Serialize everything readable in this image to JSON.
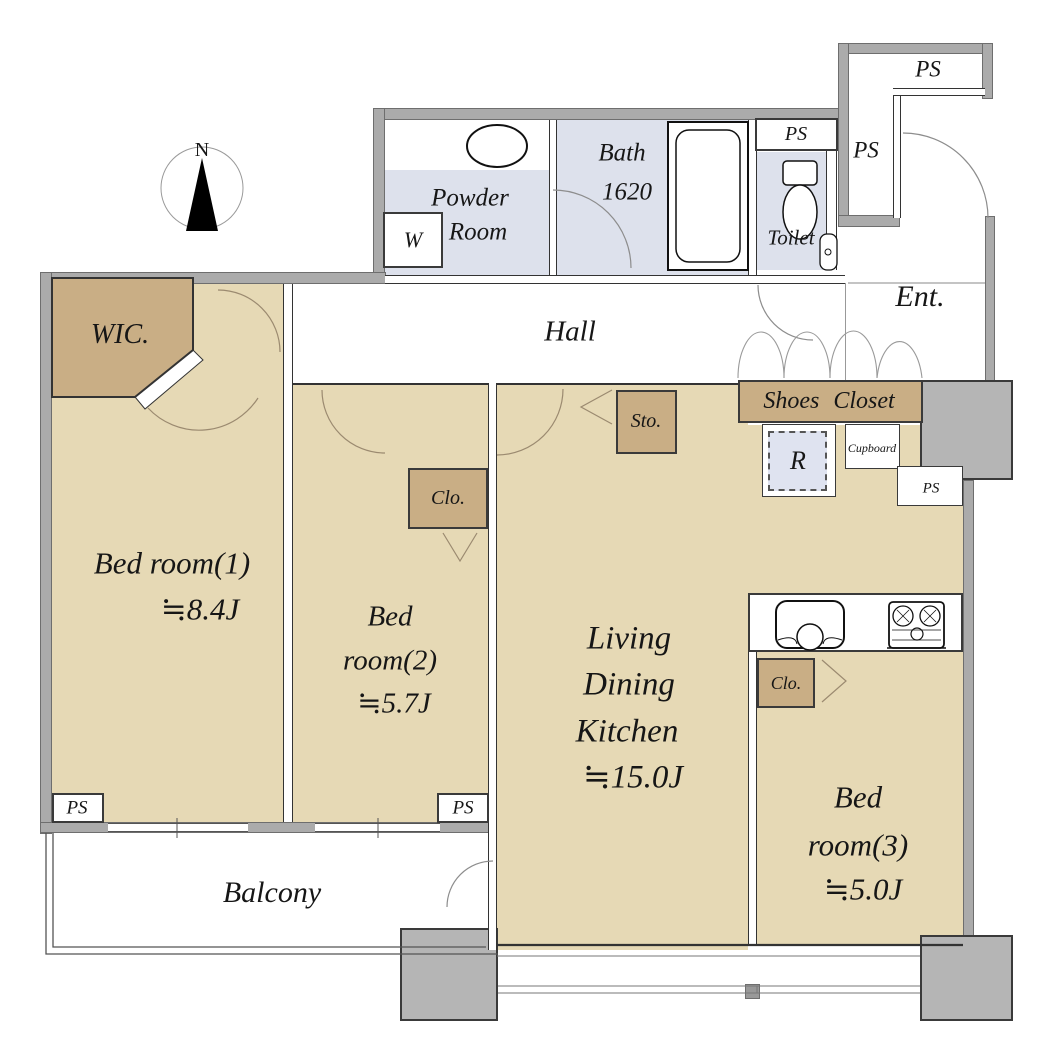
{
  "compass": {
    "label": "N"
  },
  "rooms": {
    "powder_room": {
      "line1": "Powder",
      "line2": "Room"
    },
    "bath": {
      "line1": "Bath",
      "line2": "1620"
    },
    "toilet": {
      "label": "Toilet"
    },
    "entrance": {
      "label": "Ent."
    },
    "hall": {
      "label": "Hall"
    },
    "wic": {
      "label": "WIC."
    },
    "bedroom1": {
      "line1": "Bed room(1)",
      "line2": "≒8.4J"
    },
    "bedroom2": {
      "line1": "Bed",
      "line2": "room(2)",
      "line3": "≒5.7J"
    },
    "ldk": {
      "line1": "Living",
      "line2": "Dining",
      "line3": "Kitchen",
      "line4": "≒15.0J"
    },
    "bedroom3": {
      "line1": "Bed",
      "line2": "room(3)",
      "line3": "≒5.0J"
    },
    "balcony": {
      "label": "Balcony"
    }
  },
  "storage": {
    "shoes_closet": "Shoes Closet",
    "storage_label": "Sto.",
    "closet_bedroom2": "Clo.",
    "closet_bedroom3": "Clo.",
    "cupboard": "Cupboard"
  },
  "fixtures": {
    "washer": "W",
    "refrigerator": "R"
  },
  "ps_labels": [
    "PS",
    "PS",
    "PS",
    "PS",
    "PS",
    "PS"
  ],
  "colors": {
    "floor_tan": "#e6d9b5",
    "closet_tan": "#c9ae85",
    "wet_area": "#dde1ec",
    "wall_gray": "#ababab",
    "column_gray": "#b5b5b5"
  }
}
